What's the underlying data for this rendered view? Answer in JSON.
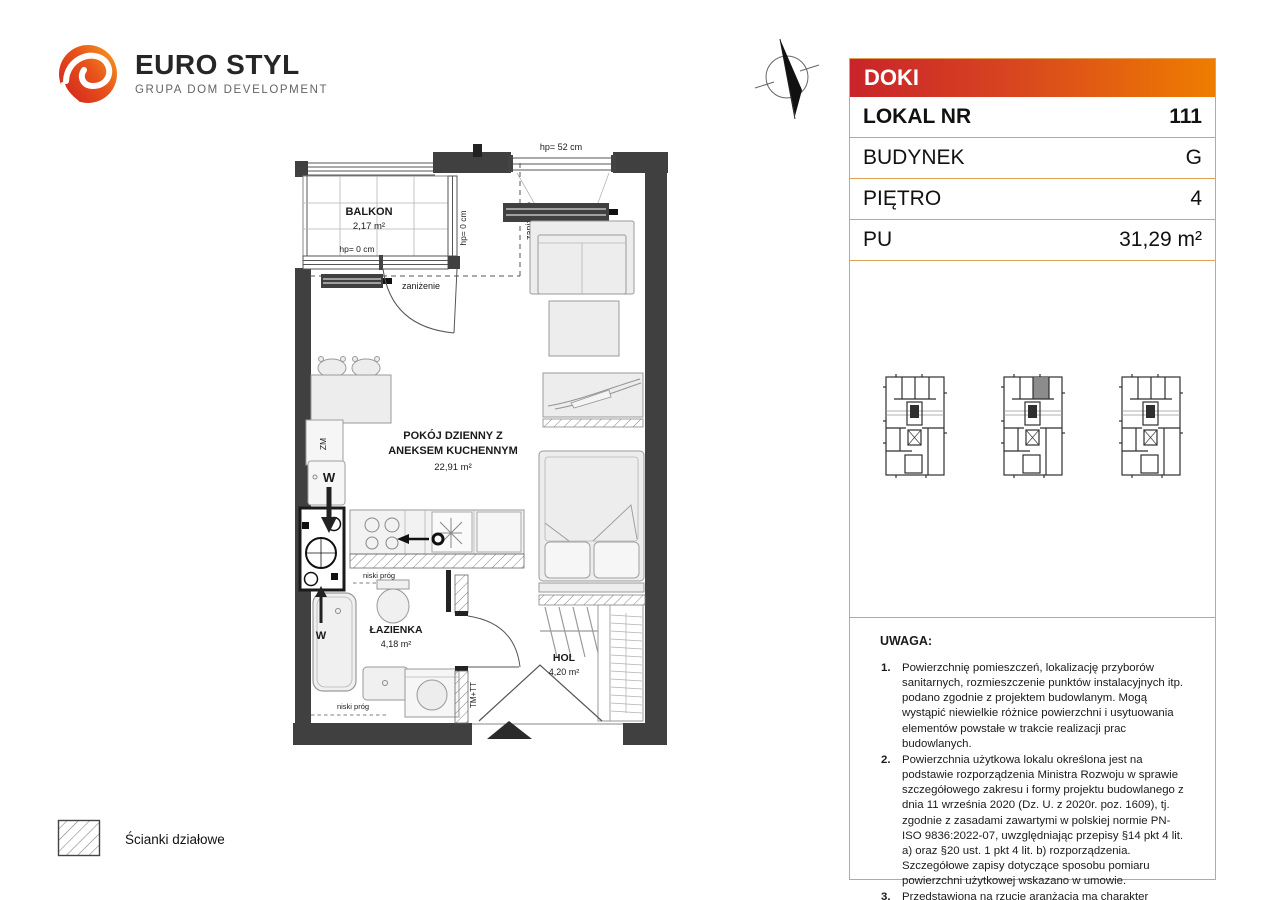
{
  "logo": {
    "title": "EURO STYL",
    "subtitle": "GRUPA DOM DEVELOPMENT"
  },
  "panel": {
    "project_name": "DOKI",
    "rows": [
      {
        "label": "LOKAL NR",
        "value": "111"
      },
      {
        "label": "BUDYNEK",
        "value": "G"
      },
      {
        "label": "PIĘTRO",
        "value": "4"
      },
      {
        "label": "PU",
        "value": "31,29 m²"
      }
    ]
  },
  "plan": {
    "rooms": {
      "balkon": {
        "name": "BALKON",
        "area": "2,17 m²"
      },
      "pokoj": {
        "name_line1": "POKÓJ DZIENNY Z",
        "name_line2": "ANEKSEM KUCHENNYM",
        "area": "22,91 m²"
      },
      "lazienka": {
        "name": "ŁAZIENKA",
        "area": "4,18 m²"
      },
      "hol": {
        "name": "HOL",
        "area": "4,20 m²"
      }
    },
    "annotations": {
      "hp_52": "hp= 52 cm",
      "hp_0": "hp= 0 cm",
      "zanizenie": "zaniżenie",
      "niski_prog": "niski próg",
      "zm": "ZM",
      "w": "W",
      "tm_tt": "TM+TT"
    }
  },
  "notes": {
    "title": "UWAGA:",
    "items": [
      "Powierzchnię pomieszczeń, lokalizację przyborów sanitarnych, rozmieszczenie punktów instalacyjnych itp. podano zgodnie z projektem budowlanym. Mogą wystąpić niewielkie różnice powierzchni i usytuowania elementów powstałe w trakcie realizacji prac budowlanych.",
      "Powierzchnia użytkowa lokalu określona jest na podstawie rozporządzenia Ministra Rozwoju w sprawie szczegółowego zakresu i formy projektu budowlanego z dnia 11 września 2020 (Dz. U. z 2020r. poz. 1609), tj. zgodnie z zasadami zawartymi w polskiej normie PN-ISO 9836:2022-07, uwzględniając przepisy §14 pkt 4 lit. a) oraz §20 ust. 1 pkt 4 lit. b) rozporządzenia. Szczegółowe zapisy dotyczące sposobu pomiaru powierzchni użytkowej wskazano w umowie.",
      "Przedstawiona na rzucie aranżacja ma charakter przykładowy, umeblowanie i zabudowy instalacyjne nie stanowią wyposażenia nabywanego lokalu."
    ]
  },
  "legend": {
    "partition_walls": "Ścianki działowe"
  },
  "colors": {
    "header_gradient_start": "#c9242b",
    "header_gradient_end": "#ef7d00",
    "panel_border": "#dfa155",
    "wall": "#404040",
    "highlight_unit": "#8c8c8c"
  }
}
